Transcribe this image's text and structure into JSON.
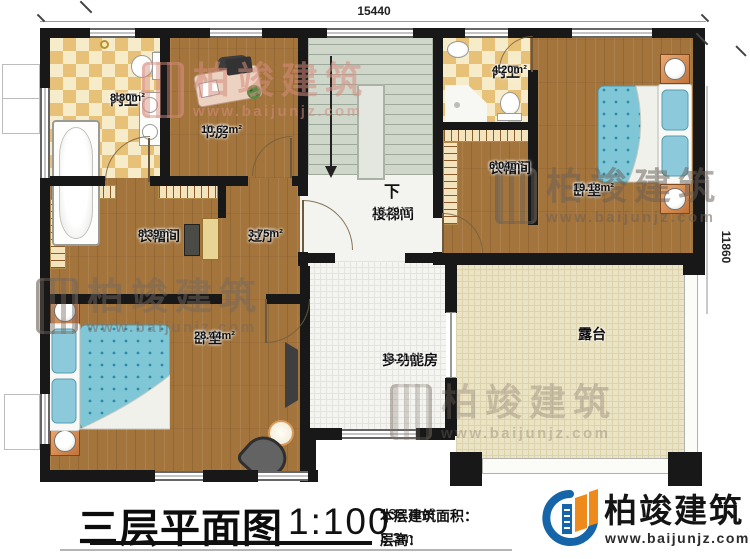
{
  "title_block": {
    "title": "三层平面图",
    "scale": "1:100",
    "floor_area_label": "本层建筑面积：",
    "floor_area_value": "138.4m²",
    "floor_height_label": "层高：",
    "floor_height_value": "3.3m"
  },
  "brand": {
    "name": "柏竣建筑",
    "url": "www.baijunjz.com"
  },
  "watermark": {
    "name": "柏竣建筑",
    "url": "www.baijunjz.com"
  },
  "dimensions": {
    "top_width": "15440",
    "right_height": "11860"
  },
  "stairs": {
    "down_label": "下"
  },
  "rooms": [
    {
      "id": "bath-1",
      "name": "内卫",
      "area": "8.80m²"
    },
    {
      "id": "study",
      "name": "书房",
      "area": "10.62m²"
    },
    {
      "id": "bath-2",
      "name": "内卫",
      "area": "4.20m²"
    },
    {
      "id": "stairwell",
      "name": "楼梯间",
      "area": "16.29m²"
    },
    {
      "id": "closet-2",
      "name": "衣帽间",
      "area": "6.04m²"
    },
    {
      "id": "bedroom-2",
      "name": "卧室",
      "area": "19.18m²"
    },
    {
      "id": "closet-1",
      "name": "衣帽间",
      "area": "8.39m²"
    },
    {
      "id": "hall",
      "name": "过厅",
      "area": "3.75m²"
    },
    {
      "id": "bedroom-1",
      "name": "卧室",
      "area": "28.44m²"
    },
    {
      "id": "multi-room",
      "name": "多功能房",
      "area": "13.21m²"
    },
    {
      "id": "terrace",
      "name": "露台",
      "area": ""
    }
  ],
  "colors": {
    "wall": "#181818",
    "wood_floor": "#a3743c",
    "tile_light": "#f7ecca",
    "tile_dark": "#e8c178",
    "stair_floor": "#cfd6ca",
    "terrace_floor": "#ebe3c5",
    "bed_blue": "#7fc6d7",
    "brand_blue": "#1565a8",
    "brand_orange": "#ee8a1c"
  }
}
